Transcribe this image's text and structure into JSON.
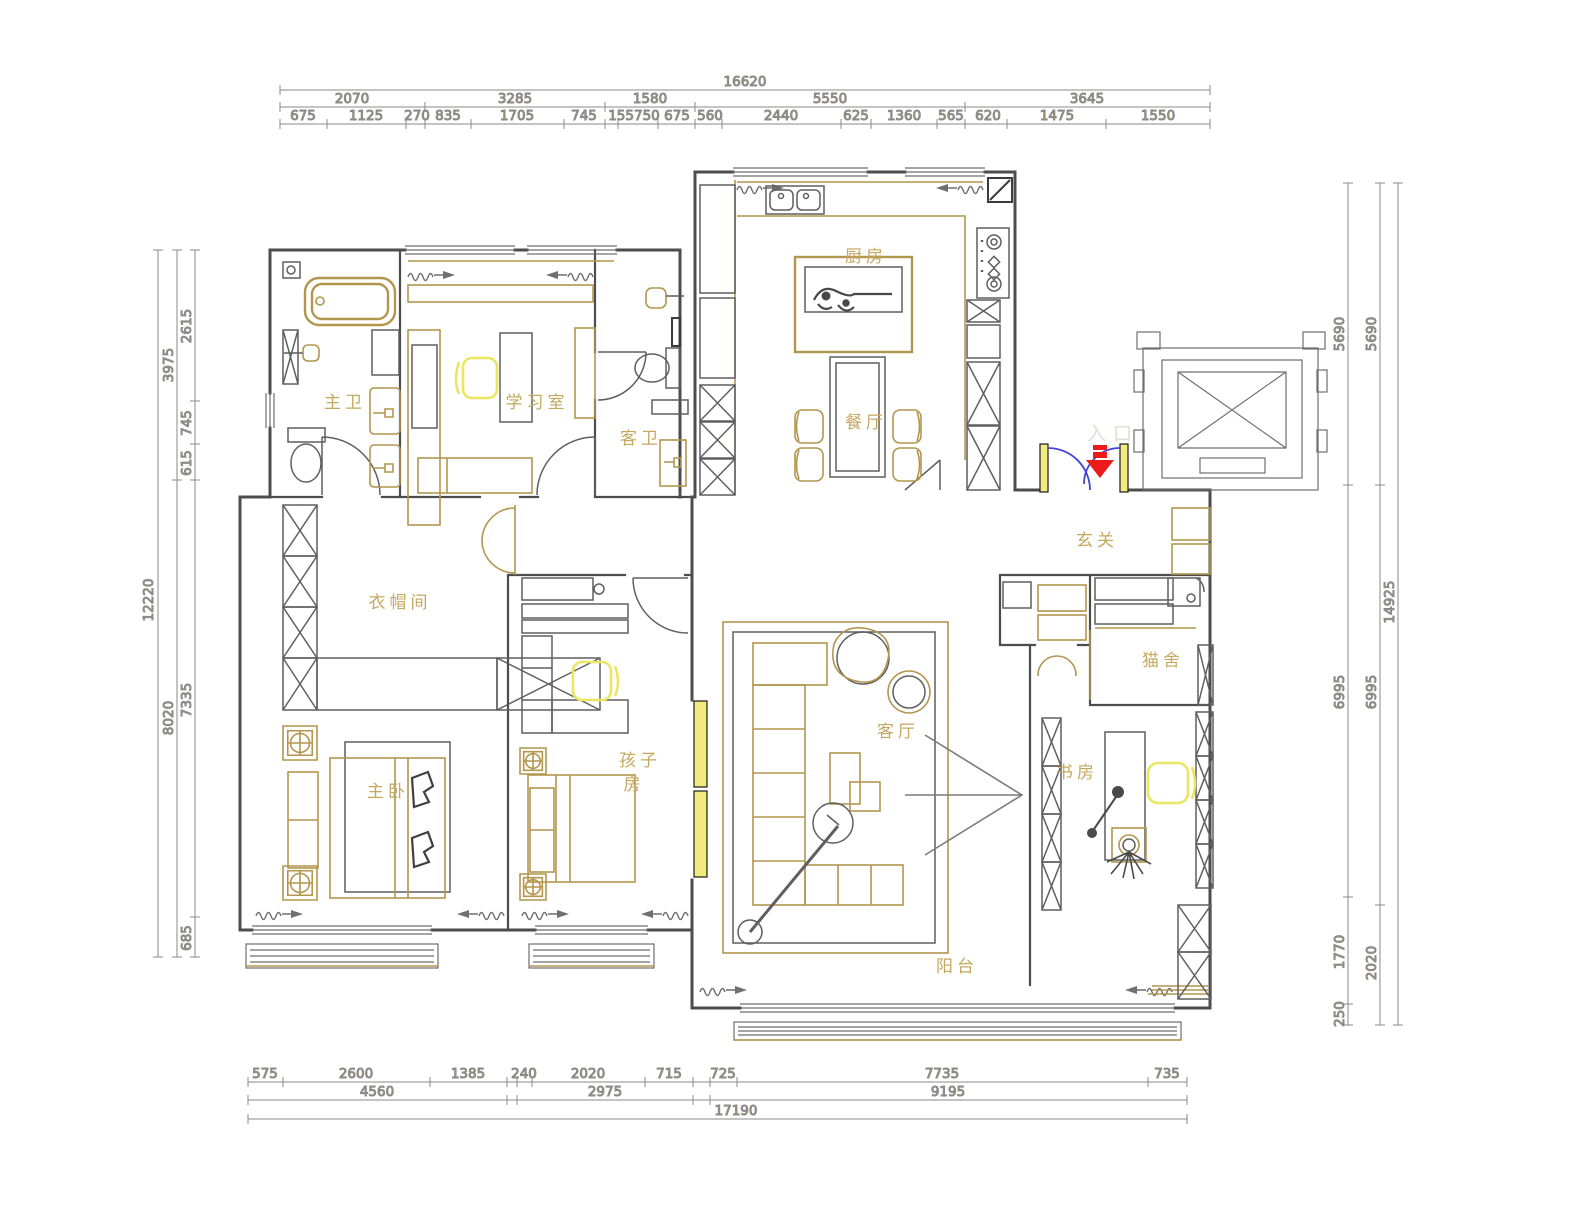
{
  "drawing": {
    "type": "apartment-floor-plan"
  },
  "rooms": {
    "master_bath": "主卫",
    "study_room": "学习室",
    "guest_bath": "客卫",
    "kitchen": "厨房",
    "dining": "餐厅",
    "foyer": "玄关",
    "cloakroom": "衣帽间",
    "master_bedroom": "主卧",
    "kids_room_line1": "孩子",
    "kids_room_line2": "房",
    "living": "客厅",
    "cattery": "猫舍",
    "study": "书房",
    "balcony": "阳台",
    "entrance_mark": "入口"
  },
  "dims": {
    "top": {
      "total": "16620",
      "seg": [
        "2070",
        "3285",
        "1580",
        "5550",
        "3645"
      ],
      "sub": [
        "675",
        "1125",
        "270",
        "835",
        "1705",
        "745",
        "155750",
        "675",
        "560",
        "2440",
        "625",
        "1360",
        "565",
        "620",
        "1475",
        "1550"
      ]
    },
    "left": {
      "total": "12220",
      "seg": [
        "3975",
        "8020"
      ],
      "sub": [
        "2615",
        "745",
        "615",
        "7335",
        "685"
      ]
    },
    "right": {
      "total": "14925",
      "mid": [
        "5690",
        "6995",
        "2020"
      ],
      "inner": [
        "5690",
        "6995",
        "1770",
        "250"
      ]
    },
    "bottom": {
      "total": "17190",
      "mid": [
        "4560",
        "2975",
        "9195"
      ],
      "sub": [
        "575",
        "2600",
        "1385",
        "240",
        "2020",
        "715",
        "725",
        "7735",
        "735"
      ]
    }
  },
  "colors": {
    "wall": "#4d4d4d",
    "furniture": "#b3964e",
    "dimension_text": "#b3994f",
    "highlight_yellow": "#f1eb7d",
    "door_swing_blue": "#4343d8",
    "entry_arrow_red": "#ec1b1b"
  }
}
